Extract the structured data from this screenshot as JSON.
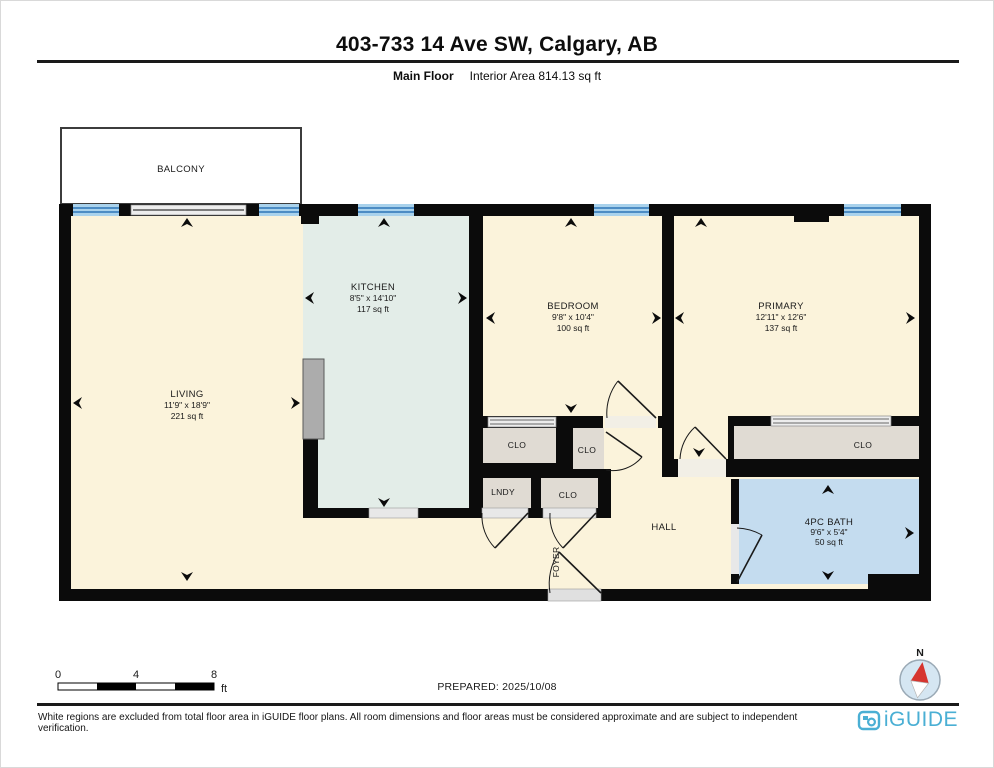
{
  "header": {
    "title": "403-733 14 Ave SW, Calgary, AB",
    "floor_label": "Main Floor",
    "area_label": "Interior Area 814.13 sq ft"
  },
  "rooms": {
    "balcony": {
      "name": "BALCONY"
    },
    "living": {
      "name": "LIVING",
      "dims": "11'9\" x 18'9\"",
      "area": "221 sq ft"
    },
    "kitchen": {
      "name": "KITCHEN",
      "dims": "8'5\" x 14'10\"",
      "area": "117 sq ft"
    },
    "bedroom": {
      "name": "BEDROOM",
      "dims": "9'8\" x 10'4\"",
      "area": "100 sq ft"
    },
    "primary": {
      "name": "PRIMARY",
      "dims": "12'11\" x 12'6\"",
      "area": "137 sq ft"
    },
    "bath": {
      "name": "4PC BATH",
      "dims": "9'6\" x 5'4\"",
      "area": "50 sq ft"
    },
    "hall": {
      "name": "HALL"
    },
    "foyer": {
      "name": "FOYER"
    },
    "lndy": {
      "name": "LNDY"
    },
    "clo_bedroom": {
      "name": "CLO"
    },
    "clo_hall": {
      "name": "CLO"
    },
    "clo_mid": {
      "name": "CLO"
    },
    "clo_primary": {
      "name": "CLO"
    }
  },
  "scale": {
    "start": "0",
    "mid": "4",
    "end": "8",
    "unit": "ft"
  },
  "prepared_label": "PREPARED: 2025/10/08",
  "compass": {
    "north_label": "N"
  },
  "footer": {
    "disclaimer": "White regions are excluded from total floor area in iGUIDE floor plans. All room dimensions and floor areas must be considered approximate and are subject to independent verification.",
    "brand": "iGUIDE"
  },
  "colors": {
    "wall": "#0b0b0b",
    "room_cream": "#FBF3DB",
    "kitchen_teal": "#E3EDE8",
    "bath_blue": "#C4DCEF",
    "closet_gray": "#E0DBD3",
    "window_blue": "#A9D2EC",
    "window_line": "#2E75B6",
    "brand_blue": "#4AAFD4",
    "compass_red": "#D6352F"
  }
}
